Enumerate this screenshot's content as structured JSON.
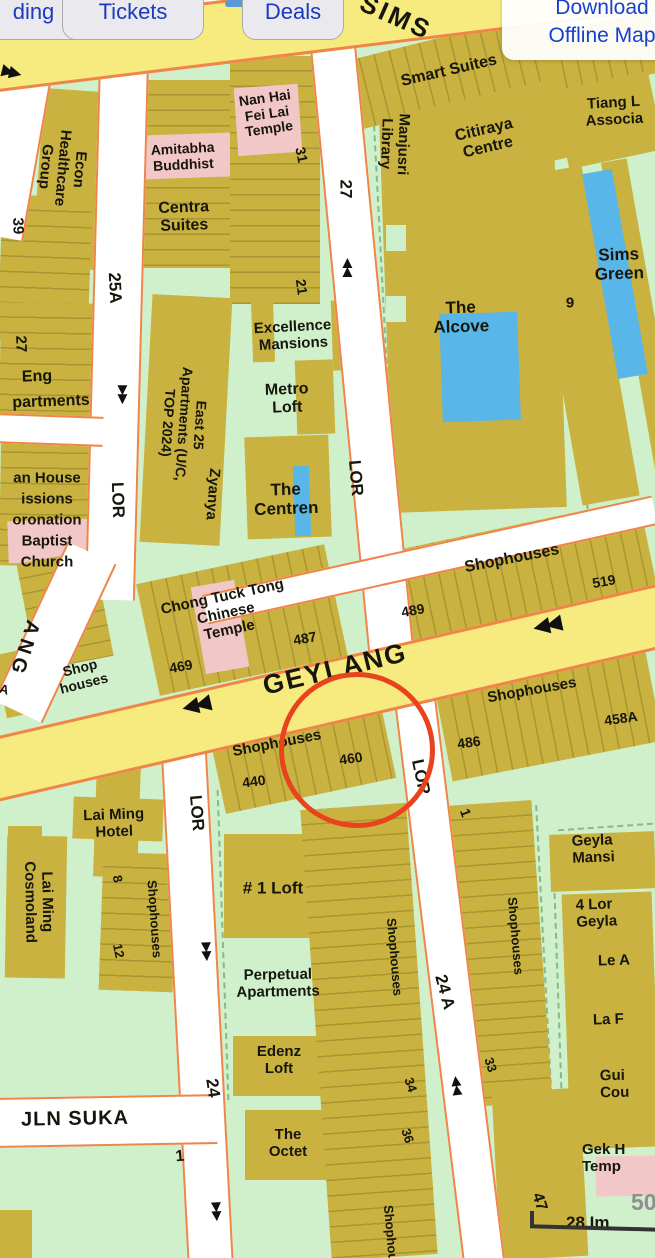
{
  "toolbar": {
    "btn1": "ding",
    "btn2": "Tickets",
    "btn3": "Deals",
    "download": "Download\nOffline Map"
  },
  "icons": {
    "arrows_left": "◀◀",
    "arrows_right": "▶▶",
    "arrows_up": "▲\n▲",
    "arrows_down": "▼\n▼"
  },
  "roads": {
    "sims": "SIMS",
    "geylang": "GEYLANG",
    "jln_suka": "JLN SUKA",
    "ang": "ANG",
    "lor": "LOR",
    "n25a": "25A",
    "n27": "27",
    "n24": "24",
    "n24a": "24 A"
  },
  "places": {
    "econ": "Econ\nHealthcare\nGroup",
    "eng1": "Eng",
    "eng2": "partments",
    "house": "an House\nissions\noronation\nBaptist\nChurch",
    "shop_small": "Shop\nhouses",
    "nanhai": "Nan Hai\nFei Lai\nTemple",
    "amitabha": "Amitabha\nBuddhist",
    "centra": "Centra\nSuites",
    "excellence": "Excellence\nMansions",
    "metro": "Metro\nLoft",
    "east25": "East 25\nApartments (U/C,\nTOP 2024)",
    "zyanya": "Zyanya",
    "centren": "The\nCentren",
    "chong": "Chong Tuck Tong\nChinese\nTemple",
    "smart": "Smart Suites",
    "shop_faint": "Shop",
    "manjusri": "Manjusri\nLibrary",
    "citiraya": "Citiraya\nCentre",
    "tiang": "Tiang L\nAssocia",
    "alcove": "The\nAlcove",
    "sims_green": "Sims\nGreen",
    "shophouses": "Shophouses",
    "laiming_hotel": "Lai Ming\nHotel",
    "laiming_cosmo": "Lai Ming\nCosmoland",
    "oneloft": "# 1 Loft",
    "perpetual": "Perpetual\nApartments",
    "edenz": "Edenz\nLoft",
    "octet": "The\nOctet",
    "geylang_mansions": "Geyla\nMansi",
    "four_lor": "4 Lor\nGeyla",
    "le_a": "Le A",
    "la_f": "La F",
    "gui": "Gui\nCou",
    "gek": "Gek H\nTemp",
    "im28": "28 Im"
  },
  "nums": {
    "n39": "39",
    "n27": "27",
    "n31": "31",
    "n21": "21",
    "n9": "9",
    "n469": "469",
    "n487": "487",
    "n489": "489",
    "n519": "519",
    "n440": "440",
    "n460": "460",
    "n486": "486",
    "n458a": "458A",
    "n8": "8",
    "n12": "12",
    "n34": "34",
    "n36": "36",
    "n33": "33",
    "n47": "47",
    "n1": "1",
    "n1b": "1",
    "n50": "50",
    "a": "A"
  },
  "colors": {
    "block_green": "#cff0cb",
    "building_olive": "#c9b23f",
    "temple_pink": "#f2c7c7",
    "pool_blue": "#58b6e8",
    "road_yellow": "#f7eb80",
    "road_border_orange": "#ef8548",
    "highlight_red": "#e8431c",
    "button_blue_text": "#1c3ac0"
  }
}
